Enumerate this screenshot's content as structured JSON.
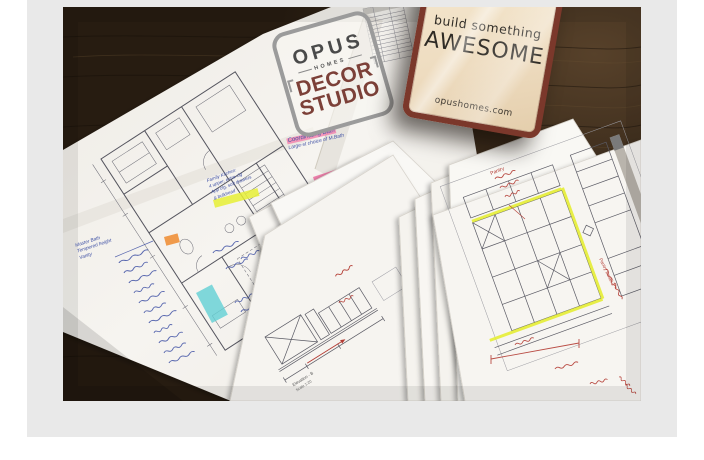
{
  "page": {
    "background": "#ffffff",
    "panel_color": "#e9e9e9"
  },
  "photo": {
    "description": "Architectural floor plans and millwork elevation sheets fanned out on a dark wood table",
    "wood_color": "#2a1e12",
    "logo": {
      "brand": "OPUS",
      "sub": "HOMES",
      "line1": "DECOR",
      "line2": "STUDIO"
    },
    "sign": {
      "top_line": "build something",
      "main_line": "AWESOME",
      "website": "opushomes.com",
      "frame_color": "#7b382b",
      "face_color": "#f0e2c8"
    },
    "notes": {
      "coord1": "Coordinating Bath",
      "coord2": "Large-st choice of M.Bath",
      "fk1": "Family Kitchen:",
      "fk2": "4 upper, extra clg",
      "fk3": "App clg, soft drawers",
      "fk4": "& bulkhead",
      "mb1": "Master Bath",
      "mb2": "Tempered height",
      "mb3": "Vanity",
      "pantry": "Pantry",
      "pantry_detail": "Pantry Detail 2",
      "elev": "Elevation - B",
      "scale": "Scale 1:20"
    },
    "ink_colors": {
      "blue": "#3f51a5",
      "red": "#b33a32",
      "highlight_yellow": "#e6ee35",
      "highlight_pink": "#f478a8",
      "highlight_green": "#9ede4c",
      "highlight_orange": "#f09038",
      "highlight_teal": "#62cfd4"
    }
  }
}
